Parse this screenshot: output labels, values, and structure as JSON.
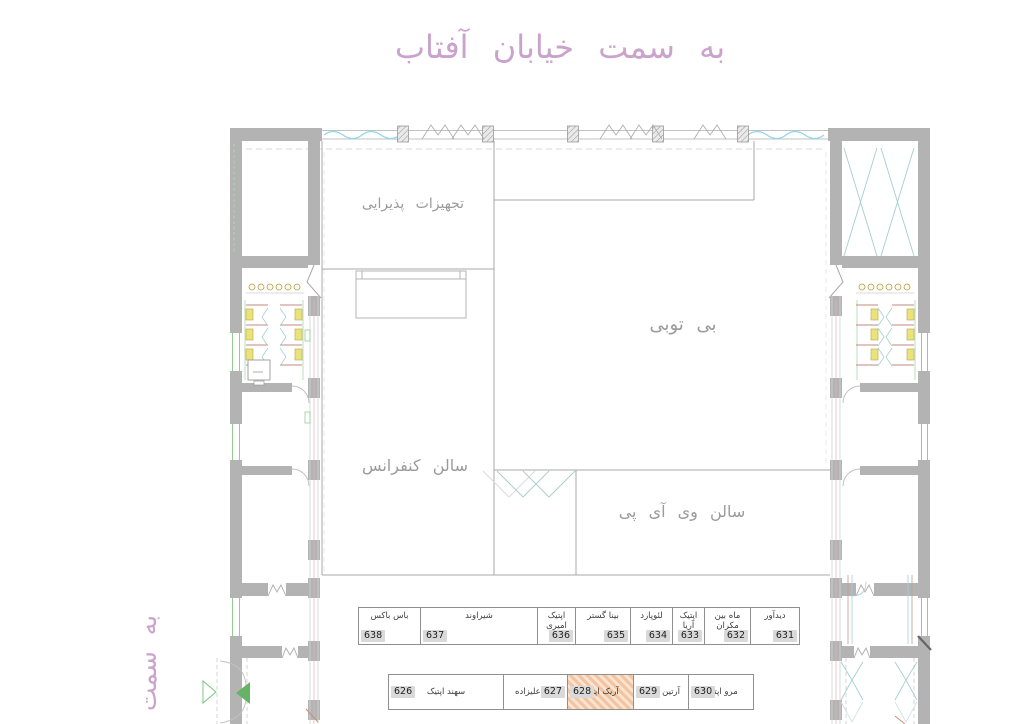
{
  "header": {
    "street_title": "به سمت خیابان آفتاب"
  },
  "side": {
    "street_label": "به سمت"
  },
  "rooms": {
    "catering_label": "تجهیزات پذیرایی",
    "main_hall_label": "بی توبی",
    "conference_label": "سالن کنفرانس",
    "vip_label": "سالن وی آی پی"
  },
  "shops": {
    "top_row": [
      {
        "number": "638",
        "name": "باس باکس"
      },
      {
        "number": "637",
        "name": "شیراوند"
      },
      {
        "number": "636",
        "name": "اپتیک امیری"
      },
      {
        "number": "635",
        "name": "بینا گستر"
      },
      {
        "number": "634",
        "name": "لئوپارد"
      },
      {
        "number": "633",
        "name": "اپتیک آریا"
      },
      {
        "number": "632",
        "name": "ماه بین مکران"
      },
      {
        "number": "631",
        "name": "دیدآور"
      }
    ],
    "bottom_row": [
      {
        "number": "626",
        "name": "سهند اپتیک"
      },
      {
        "number": "627",
        "name": "جلد علیزاده"
      },
      {
        "number": "628",
        "name": "آریک اپتیک",
        "highlighted": true
      },
      {
        "number": "629",
        "name": "آرتین اپتیک"
      },
      {
        "number": "630",
        "name": "مرو اپتیک"
      }
    ]
  },
  "colors": {
    "street_text": "#c9a3cb",
    "room_text": "#9b9b9b",
    "wall_gray": "#b3b3b3",
    "glass_cyan": "#8ed8e8",
    "door_teal": "#a5cfcf",
    "window_green": "#8fce8f",
    "stall_red": "#c4887c",
    "fixture_yellow": "#ece27a",
    "highlight_orange": "#f2c4a2",
    "badge_gray": "#d9d9d9"
  }
}
